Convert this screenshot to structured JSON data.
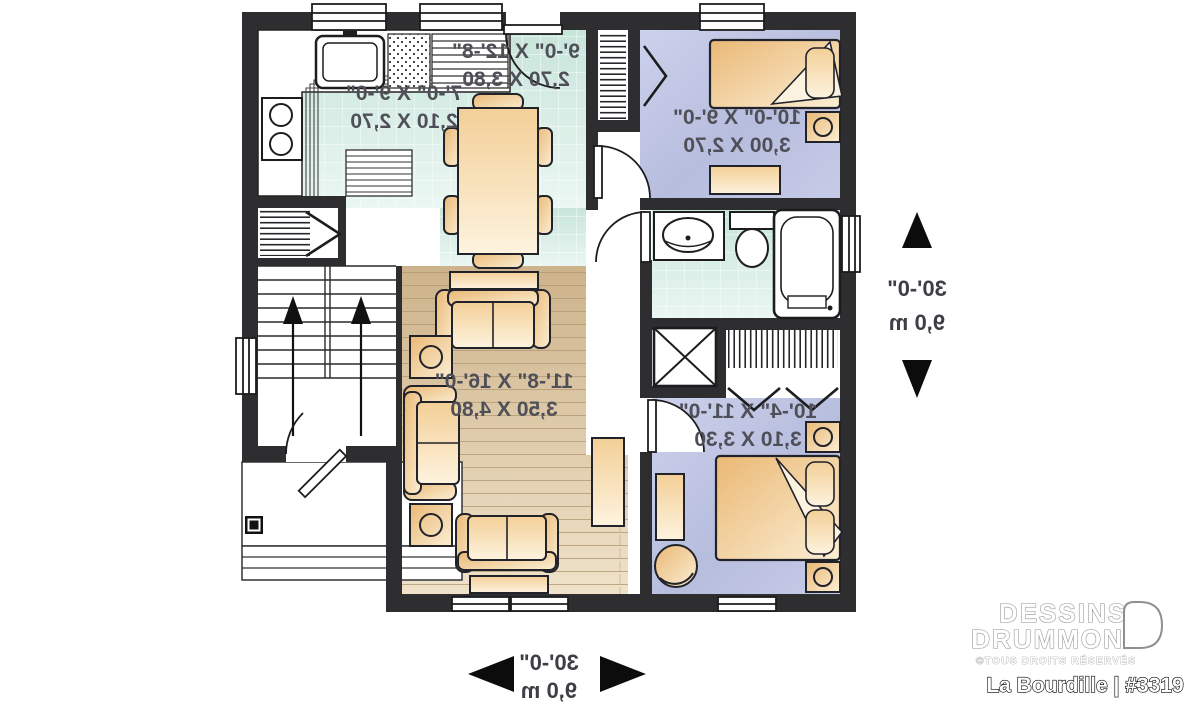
{
  "plan": {
    "rooms": [
      {
        "id": "kitchen",
        "dim_ft": "7'-0\" X 9'-0\"",
        "dim_m": "2,10 X 2,70"
      },
      {
        "id": "dining",
        "dim_ft": "9'-0\" X 12'-8\"",
        "dim_m": "2,70 X 3,80"
      },
      {
        "id": "bedroom-1",
        "dim_ft": "10'-0\" X 9'-0\"",
        "dim_m": "3,00 X 2,70"
      },
      {
        "id": "living",
        "dim_ft": "11'-8\" X 16'-0\"",
        "dim_m": "3,50 X 4,80"
      },
      {
        "id": "bedroom-2",
        "dim_ft": "10'-4\" X 11'-0\"",
        "dim_m": "3,10 X 3,30"
      }
    ],
    "overall": {
      "side_ft": "30'-0\"",
      "side_m": "9,0 m",
      "bottom_ft": "30'-0\"",
      "bottom_m": "9,0 m"
    }
  },
  "branding": {
    "line1": "DESSINS",
    "line2": "DRUMMOND",
    "rights": "©TOUS DROITS RÉSERVÉS",
    "plan_name": "La Bourdille | #3319"
  },
  "colors": {
    "wall": "#2e2e31",
    "tile_floor": "#cfe8df",
    "bedroom_floor": "#b9bfdf",
    "wood_floor": "#d8c3a0",
    "furniture": "#efc287"
  }
}
